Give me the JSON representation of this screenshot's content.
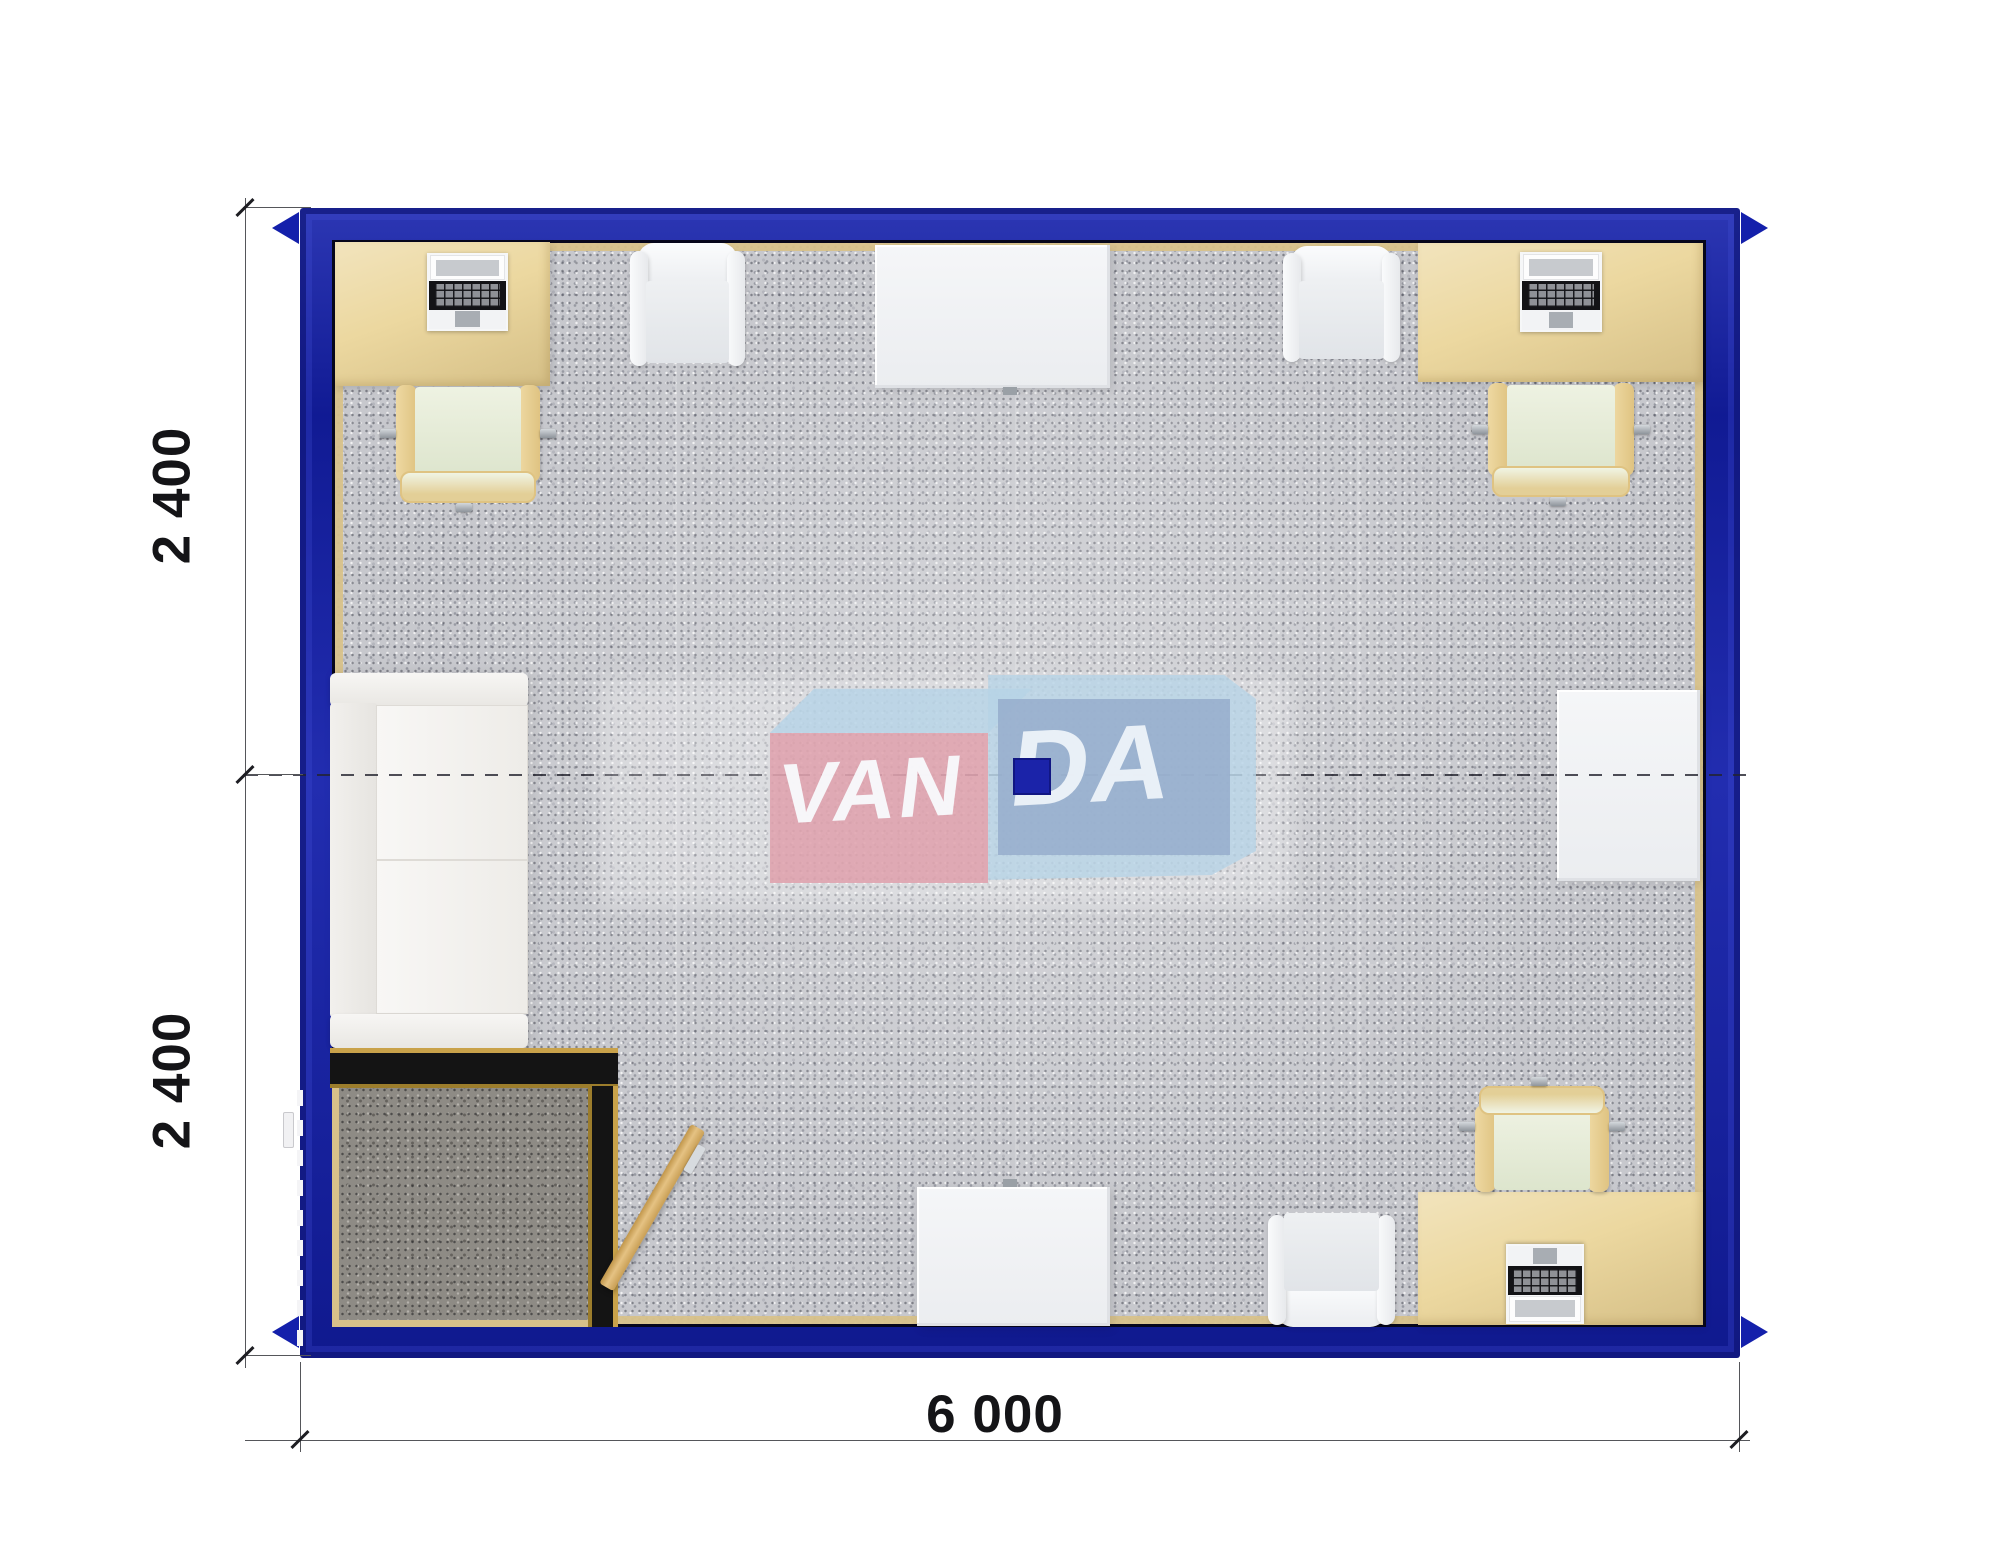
{
  "dimensions": {
    "left_upper_module": "2 400",
    "left_lower_module": "2 400",
    "bottom_width": "6 000"
  },
  "watermark": {
    "left_text": "VAN",
    "right_text": "DA"
  },
  "colors": {
    "wall_blue": "#1420ab",
    "wall_blue_dark": "#0a1170",
    "desk_beige": "#ecd8a0",
    "carpet": "#c7c8cd",
    "vestibule_floor": "#8e8b85",
    "vestibule_wall": "#141414",
    "gold_trim": "#c9a24a",
    "door_wood": "#d9b26c",
    "logo_pink": "#dfa0ac",
    "logo_light_blue": "#b7d3e6",
    "logo_steel_blue": "#94aacb",
    "logo_square_blue": "#1b23a9"
  }
}
